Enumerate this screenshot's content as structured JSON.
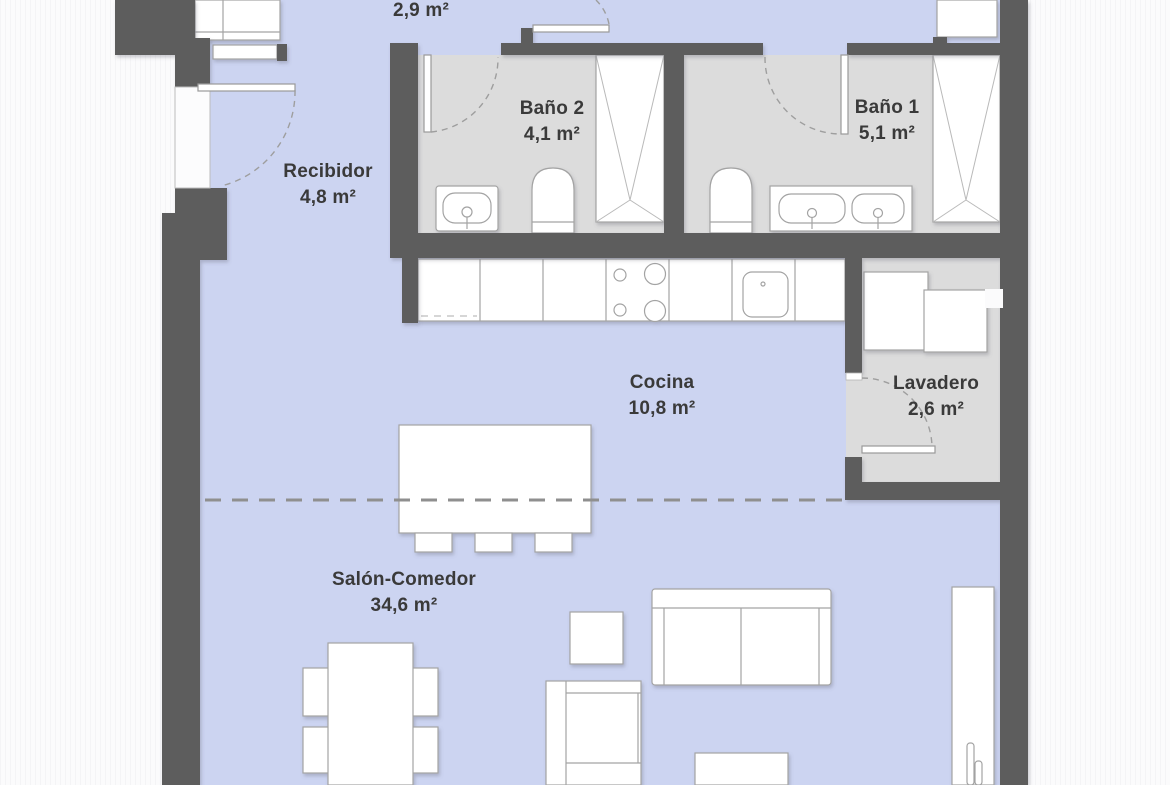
{
  "plan": {
    "rooms": [
      {
        "name": "",
        "area": "2,9 m²"
      },
      {
        "name": "Recibidor",
        "area": "4,8 m²"
      },
      {
        "name": "Baño 2",
        "area": "4,1 m²"
      },
      {
        "name": "Baño 1",
        "area": "5,1 m²"
      },
      {
        "name": "Cocina",
        "area": "10,8 m²"
      },
      {
        "name": "Lavadero",
        "area": "2,6 m²"
      },
      {
        "name": "Salón-Comedor",
        "area": "34,6 m²"
      }
    ],
    "colors": {
      "floor_living": "#ccd4f1",
      "floor_wet": "#dcdcdc",
      "wall": "#5d5d5d",
      "furniture": "#ffffff",
      "outline": "#a3a3a3",
      "label_text": "#3a3a3a",
      "background": "#fbfbfc"
    }
  }
}
